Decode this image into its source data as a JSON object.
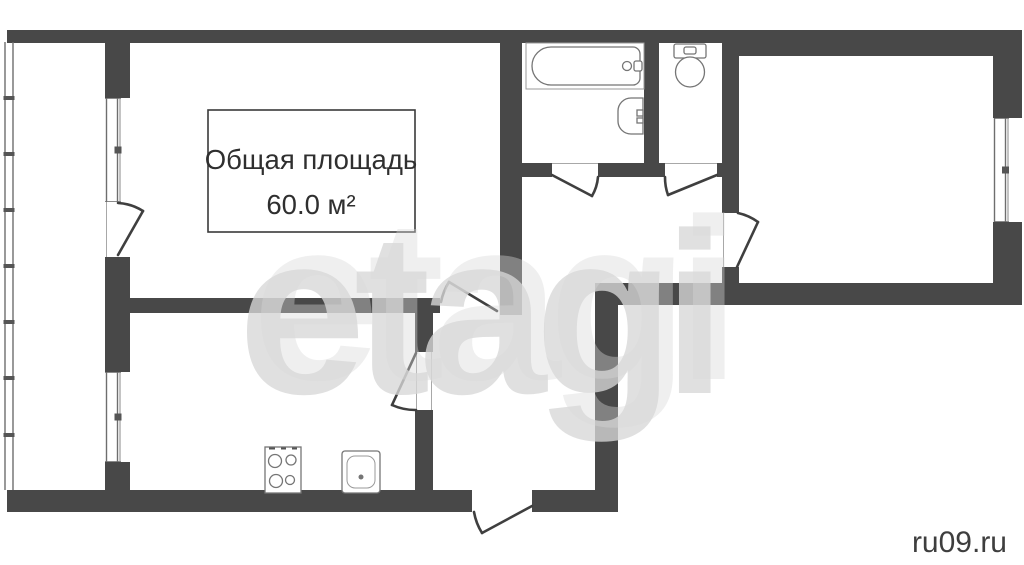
{
  "page": {
    "type": "apartment-floor-plan"
  },
  "title_box": {
    "line1": "Общая площадь",
    "line2": "60.0 м²"
  },
  "watermark": {
    "text": "etagi"
  },
  "credit": {
    "text": "ru09.ru"
  },
  "colors": {
    "wall": "#484848",
    "background": "#ffffff",
    "title_text": "#2f2f2f",
    "watermark": "#d8d8d8",
    "credit_text": "#3e3e3e",
    "fixture_outline": "#757575"
  },
  "fixtures": [
    {
      "name": "bathtub"
    },
    {
      "name": "wash-basin"
    },
    {
      "name": "toilet"
    },
    {
      "name": "stove"
    },
    {
      "name": "kitchen-sink"
    }
  ]
}
